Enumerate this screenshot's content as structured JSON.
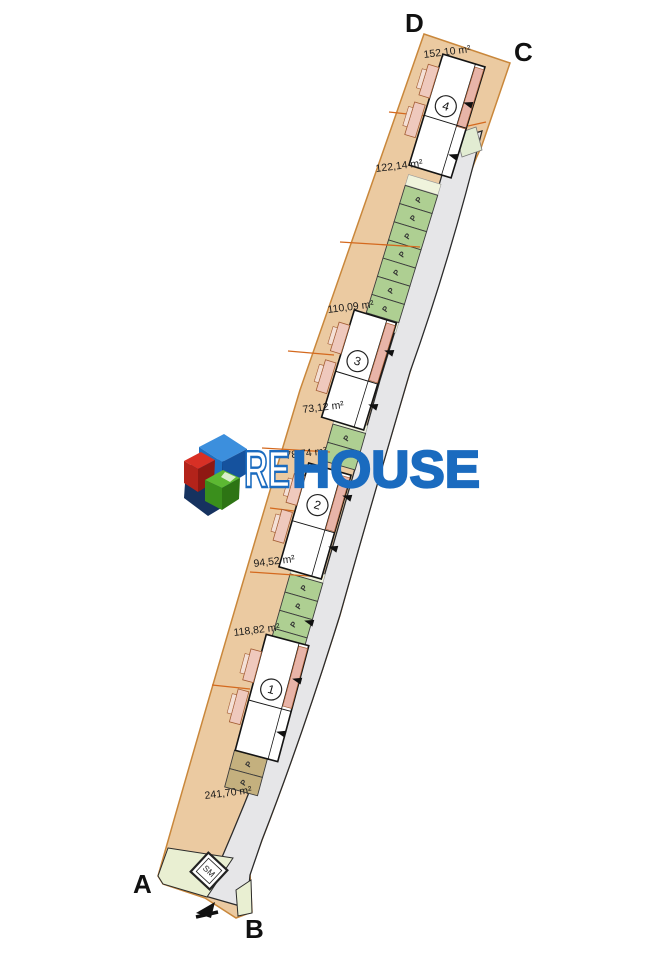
{
  "watermark": {
    "word_outline": "RE",
    "word_solid": "HOUSE",
    "brand_blue": "#1a6bbf",
    "cube_red": "#c8281e",
    "cube_green": "#4fae28",
    "cube_navy": "#16325f"
  },
  "plan": {
    "corner_labels": {
      "a": "A",
      "b": "B",
      "c": "C",
      "d": "D"
    },
    "parking_letter": "P",
    "substation_label": "SM",
    "buildings": [
      {
        "number": "1"
      },
      {
        "number": "2"
      },
      {
        "number": "3"
      },
      {
        "number": "4"
      }
    ],
    "area_labels": [
      "152,10 m²",
      "122,14 m²",
      "110,09 m²",
      "73,12 m²",
      "78,74 m²",
      "94,52 m²",
      "118,82 m²",
      "241,70 m²"
    ],
    "colors": {
      "parcel_fill": "#ebcaa1",
      "parcel_border": "#c9873b",
      "boundary_line": "#d4691e",
      "road_fill": "#e6e6e8",
      "parking_green": "#aecf92",
      "parking_olive": "#c4b07e",
      "lawn_green": "#e9efd2",
      "balcony_pink": "#efc9bd",
      "building_white": "#ffffff"
    }
  }
}
